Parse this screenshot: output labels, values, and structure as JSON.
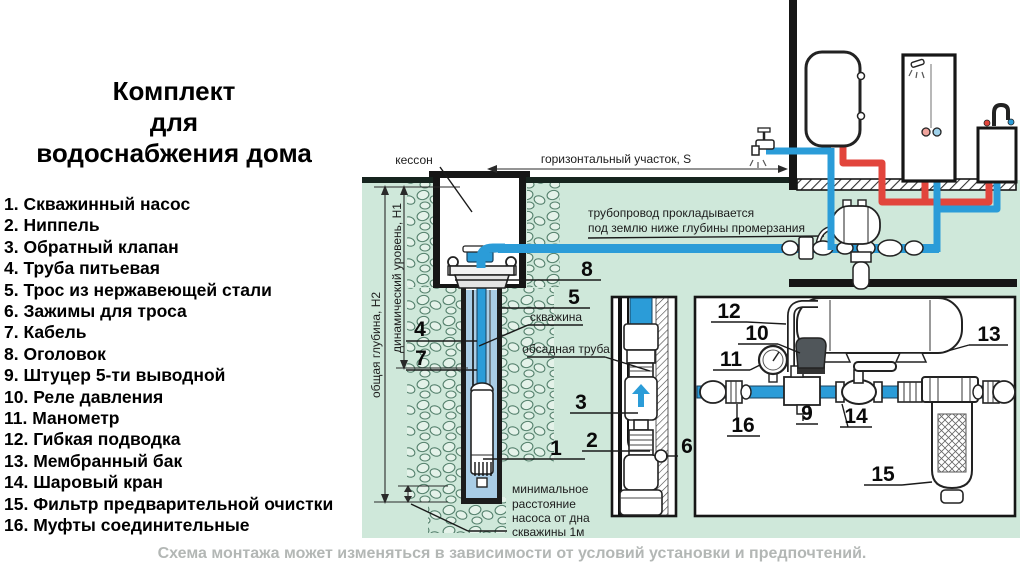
{
  "title": {
    "lines": [
      "Комплект",
      "для",
      "водоснабжения дома"
    ]
  },
  "legend": {
    "items": [
      "1. Скважинный насос",
      "2. Ниппель",
      "3. Обратный клапан",
      "4. Труба питьевая",
      "5. Трос из нержавеющей стали",
      "6. Зажимы для троса",
      "7. Кабель",
      "8. Оголовок",
      "9. Штуцер 5-ти выводной",
      "10. Реле давления",
      "11. Манометр",
      "12. Гибкая подводка",
      "13. Мембранный бак",
      "14. Шаровый кран",
      "15. Фильтр предварительной очистки",
      "16. Муфты соединительные"
    ]
  },
  "footer": {
    "note": "Схема монтажа может изменяться в зависимости от условий установки и предпочтений."
  },
  "colors": {
    "pipe_cold": "#2b9cd8",
    "pipe_hot": "#e2453c",
    "ground": "#cfe8da",
    "bore": "#a9cde6",
    "note_gray": "#b3b7b5"
  },
  "diagram": {
    "annotations": [
      {
        "id": "kesson",
        "text": "кессон",
        "x": 414,
        "y": 164,
        "a": "middle"
      },
      {
        "id": "horizontal-run",
        "text": "горизонтальный участок, S",
        "x": 616,
        "y": 163,
        "a": "middle"
      },
      {
        "id": "pipeline-note-1",
        "text": "трубопровод прокладывается",
        "x": 588,
        "y": 217,
        "a": "start"
      },
      {
        "id": "pipeline-note-2",
        "text": "под землю ниже глубины промерзания",
        "x": 588,
        "y": 232,
        "a": "start"
      },
      {
        "id": "total-depth",
        "text": "общая глубина, H2",
        "x": 380,
        "y": 345,
        "a": "middle",
        "r": -90
      },
      {
        "id": "dynamic-level",
        "text": "динамический уровень, H1",
        "x": 401,
        "y": 278,
        "a": "middle",
        "r": -90
      },
      {
        "id": "well",
        "text": "скважина",
        "x": 556,
        "y": 321,
        "a": "middle"
      },
      {
        "id": "casing-pipe",
        "text": "обсадная труба",
        "x": 566,
        "y": 353,
        "a": "middle"
      },
      {
        "id": "min-dist-1",
        "text": "минимальное",
        "x": 512,
        "y": 493,
        "a": "start"
      },
      {
        "id": "min-dist-2",
        "text": "расстояние",
        "x": 512,
        "y": 508,
        "a": "start"
      },
      {
        "id": "min-dist-3",
        "text": "насоса от дна",
        "x": 512,
        "y": 522,
        "a": "start"
      },
      {
        "id": "min-dist-4",
        "text": "скважины 1м",
        "x": 512,
        "y": 536,
        "a": "start"
      }
    ],
    "numbers": [
      {
        "n": "1",
        "x": 556,
        "y": 455
      },
      {
        "n": "2",
        "x": 592,
        "y": 447
      },
      {
        "n": "3",
        "x": 581,
        "y": 409
      },
      {
        "n": "4",
        "x": 420,
        "y": 336
      },
      {
        "n": "5",
        "x": 574,
        "y": 304
      },
      {
        "n": "6",
        "x": 687,
        "y": 453
      },
      {
        "n": "7",
        "x": 421,
        "y": 365
      },
      {
        "n": "8",
        "x": 587,
        "y": 276
      },
      {
        "n": "9",
        "x": 807,
        "y": 420
      },
      {
        "n": "10",
        "x": 757,
        "y": 340
      },
      {
        "n": "11",
        "x": 731,
        "y": 366
      },
      {
        "n": "12",
        "x": 729,
        "y": 318
      },
      {
        "n": "13",
        "x": 989,
        "y": 341
      },
      {
        "n": "14",
        "x": 856,
        "y": 423
      },
      {
        "n": "15",
        "x": 883,
        "y": 481
      },
      {
        "n": "16",
        "x": 743,
        "y": 432
      }
    ]
  }
}
